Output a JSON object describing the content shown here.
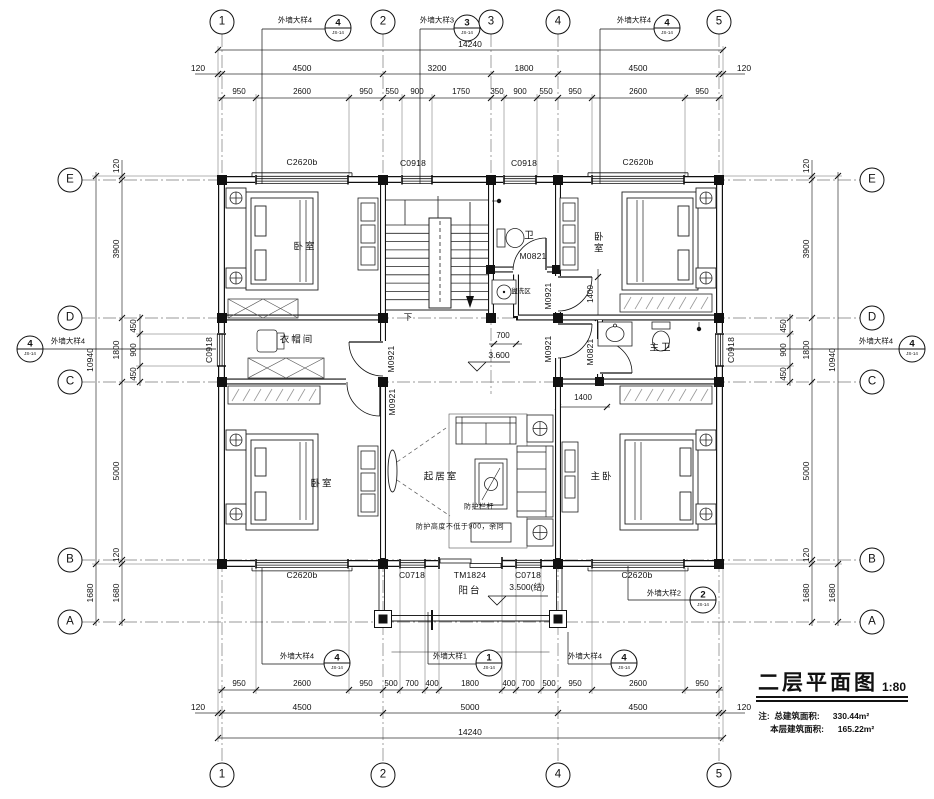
{
  "title_block": {
    "title": "二层平面图",
    "scale": "1:80",
    "note_prefix": "注:",
    "total_area_label": "总建筑面积:",
    "total_area_value": "330.44m²",
    "floor_area_label": "本层建筑面积:",
    "floor_area_value": "165.22m²"
  },
  "grid": {
    "cols": [
      "1",
      "2",
      "3",
      "4",
      "5"
    ],
    "rows": [
      "E",
      "D",
      "C",
      "B",
      "A"
    ]
  },
  "callouts": {
    "ref": "JS-14",
    "w1_label": "外墙大样1",
    "w1_num": "1",
    "w2_label": "外墙大样2",
    "w2_num": "2",
    "w3_label": "外墙大样3",
    "w3_num": "3",
    "w4_label": "外墙大样4",
    "w4_num": "4"
  },
  "openings": {
    "window_c2620b": "C2620b",
    "window_c0918": "C0918",
    "window_c0718": "C0718",
    "door_tm1824": "TM1824",
    "door_m0921": "M0921",
    "door_m0821": "M0821"
  },
  "rooms": {
    "bedroom": "卧室",
    "cloakroom": "衣帽间",
    "bath": "卫",
    "wash_area": "盥洗区",
    "master_bath": "主卫",
    "living": "起居室",
    "master_bedroom": "主卧",
    "balcony": "阳台"
  },
  "levels": {
    "second_floor": "3.600",
    "balcony": "3.500(结)"
  },
  "notes": {
    "railing": "防护栏杆",
    "railing_height": "防护高度不低于900，余同",
    "stair_down": "下"
  },
  "dims": {
    "top": {
      "total": "14240",
      "row2": [
        "120",
        "4500",
        "3200",
        "1800",
        "4500",
        "120"
      ],
      "row3": [
        "950",
        "2600",
        "950",
        "550",
        "900",
        "1750",
        "350",
        "900",
        "550",
        "950",
        "2600",
        "950"
      ]
    },
    "bottom": {
      "total": "14240",
      "row2": [
        "120",
        "4500",
        "5000",
        "4500",
        "120"
      ],
      "row1": [
        "950",
        "2600",
        "950",
        "500",
        "700",
        "400",
        "1800",
        "400",
        "700",
        "500",
        "950",
        "2600",
        "950"
      ]
    },
    "left": {
      "outer": [
        "10940",
        "1680"
      ],
      "inner": [
        "120",
        "3900",
        "1800",
        "5000",
        "120",
        "1680"
      ],
      "sub": [
        "450",
        "900",
        "450"
      ]
    },
    "right": {
      "outer": [
        "10940",
        "1680"
      ],
      "inner": [
        "120",
        "3900",
        "1800",
        "5000",
        "120",
        "1680"
      ],
      "sub": [
        "450",
        "900",
        "450"
      ]
    },
    "inplan": {
      "d700": "700",
      "d1400": "1400"
    }
  }
}
